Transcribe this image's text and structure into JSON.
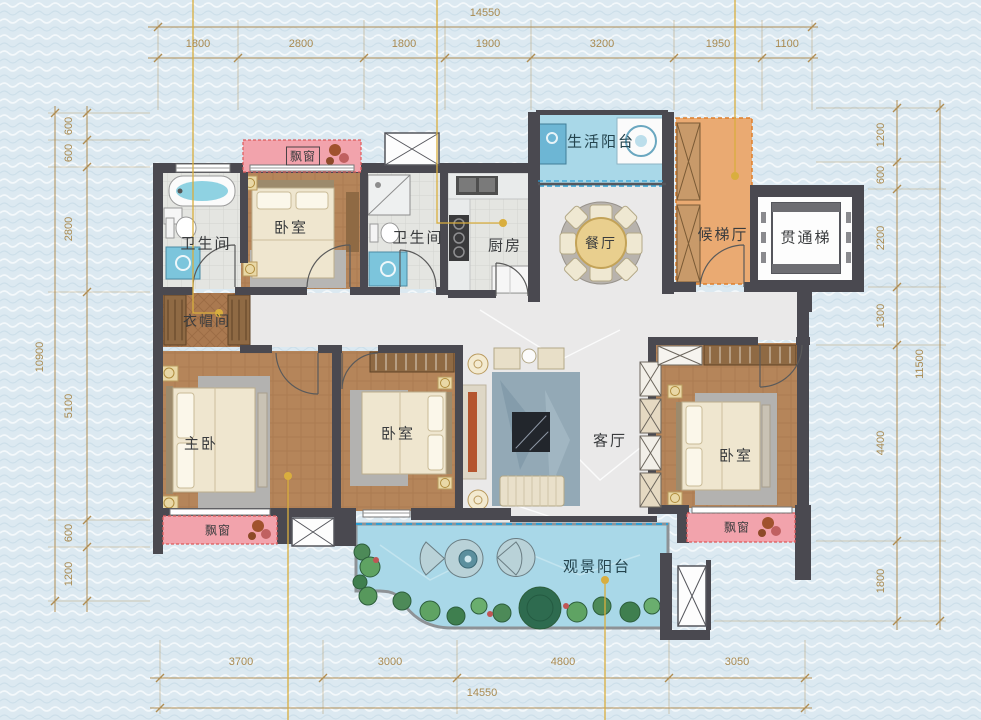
{
  "rooms": {
    "bathroom_left": "卫生间",
    "bedroom_top": "卧室",
    "bathroom_mid": "卫生间",
    "kitchen": "厨房",
    "dining": "餐厅",
    "service_balcony": "生活阳台",
    "elevator_hall": "候梯厅",
    "elevator": "贯通梯",
    "cloakroom": "衣帽间",
    "master_bedroom": "主卧",
    "bedroom_mid": "卧室",
    "living": "客厅",
    "bedroom_right": "卧室",
    "view_balcony": "观景阳台",
    "bay_window_top": "飘窗",
    "bay_window_left": "飘窗",
    "bay_window_right": "飘窗"
  },
  "dimensions": {
    "top": {
      "total": "14550",
      "segments": [
        "1800",
        "2800",
        "1800",
        "1900",
        "3200",
        "1950",
        "1100"
      ]
    },
    "bottom": {
      "total": "14550",
      "segments": [
        "3700",
        "3000",
        "4800",
        "3050"
      ]
    },
    "left": {
      "total": "10900",
      "segments": [
        "600",
        "600",
        "2800",
        "5100",
        "600",
        "1200"
      ]
    },
    "right": {
      "total": "11500",
      "segments": [
        "1200",
        "600",
        "2200",
        "1300",
        "4400",
        "1800"
      ]
    }
  },
  "colors": {
    "background": "#dce9f1",
    "wall": "#4a4950",
    "wood": "#b5855a",
    "marble": "#eae9e9",
    "bay_pink": "#f2a3ac",
    "balcony_blue": "#a9d8e8",
    "hall_orange": "#eaaa72",
    "dimension_text": "#a98a50",
    "leader_gold": "#d9ae3e",
    "fixture_blue": "#7cc5dc"
  }
}
